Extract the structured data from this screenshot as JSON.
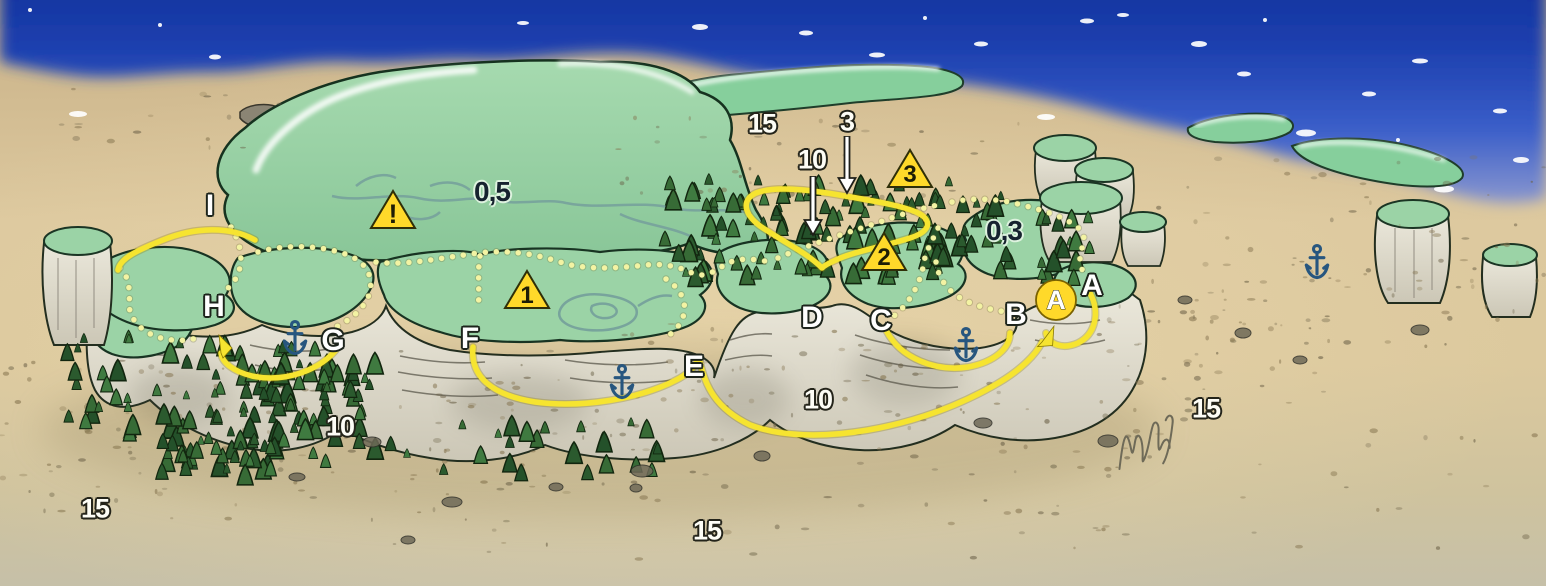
{
  "map": {
    "type": "Illustrated dive-site map of a flat-topped reef plateau",
    "colors": {
      "sea_blue": "#12309c",
      "sand": "#dcc89e",
      "plateau_green": "#9bd3a6",
      "cliff_gray": "#e6e2d4",
      "tree_green": "#2f5f33",
      "route_solid_yellow": "#f6e430",
      "route_dotted_yellow": "#f3f3a3",
      "marker_yellow": "#ffd92a",
      "anchor_blue": "#27567f",
      "label_light": "#fdfdf6",
      "label_dark": "#16222f"
    },
    "depth_labels": [
      {
        "text": "0,5",
        "x": 492,
        "y": 192,
        "style": "dark"
      },
      {
        "text": "0,3",
        "x": 1004,
        "y": 231,
        "style": "dark"
      },
      {
        "text": "15",
        "x": 762,
        "y": 124,
        "style": "light"
      },
      {
        "text": "3",
        "x": 847,
        "y": 122,
        "style": "light"
      },
      {
        "text": "10",
        "x": 812,
        "y": 160,
        "style": "light"
      },
      {
        "text": "10",
        "x": 340,
        "y": 427,
        "style": "light"
      },
      {
        "text": "10",
        "x": 818,
        "y": 400,
        "style": "light"
      },
      {
        "text": "15",
        "x": 95,
        "y": 509,
        "style": "light"
      },
      {
        "text": "15",
        "x": 707,
        "y": 531,
        "style": "light"
      },
      {
        "text": "15",
        "x": 1206,
        "y": 409,
        "style": "light"
      }
    ],
    "point_labels": [
      {
        "text": "I",
        "x": 210,
        "y": 206
      },
      {
        "text": "H",
        "x": 214,
        "y": 307
      },
      {
        "text": "G",
        "x": 333,
        "y": 341
      },
      {
        "text": "F",
        "x": 470,
        "y": 339
      },
      {
        "text": "E",
        "x": 694,
        "y": 367
      },
      {
        "text": "D",
        "x": 812,
        "y": 318
      },
      {
        "text": "C",
        "x": 881,
        "y": 321
      },
      {
        "text": "B",
        "x": 1016,
        "y": 315
      },
      {
        "text": "A",
        "x": 1092,
        "y": 286
      }
    ],
    "waypoint_markers": [
      {
        "label": "!",
        "x": 393,
        "y": 210
      },
      {
        "label": "1",
        "x": 527,
        "y": 290
      },
      {
        "label": "2",
        "x": 884,
        "y": 252
      },
      {
        "label": "3",
        "x": 910,
        "y": 169
      }
    ],
    "start_marker": {
      "label": "A",
      "x": 1056,
      "y": 300
    },
    "anchors": [
      {
        "x": 295,
        "y": 338
      },
      {
        "x": 622,
        "y": 382
      },
      {
        "x": 966,
        "y": 345
      },
      {
        "x": 1317,
        "y": 262
      }
    ],
    "down_arrows": [
      {
        "x": 847,
        "y": 136,
        "length": 42
      },
      {
        "x": 813,
        "y": 176,
        "length": 44
      }
    ],
    "signature": {
      "x": 1146,
      "y": 441
    }
  }
}
